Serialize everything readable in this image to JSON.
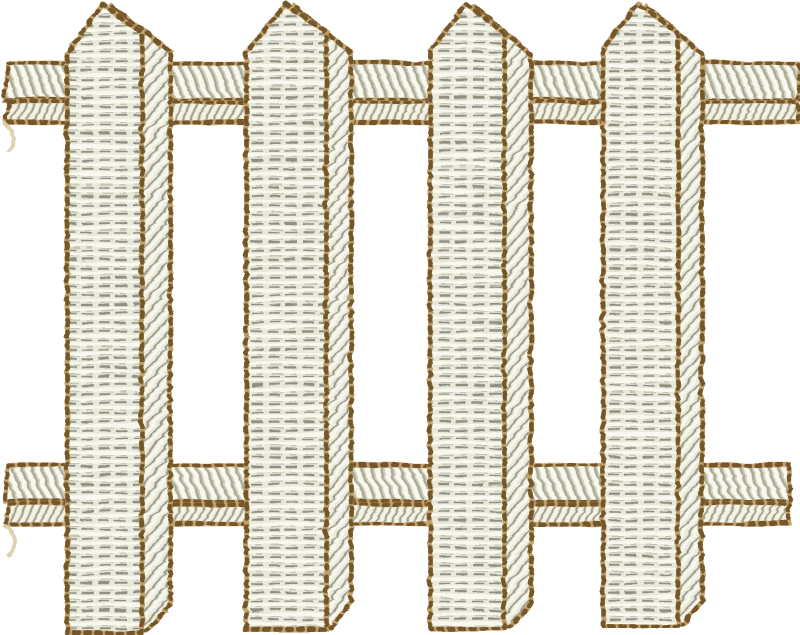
{
  "scene": {
    "description": "embroidery design of a white picket fence, four pointed pickets over two horizontal rails",
    "width": 800,
    "height": 635,
    "background": "#ffffff"
  },
  "palette": {
    "outline_base": "#c2a26c",
    "outline_dark": "#74572c",
    "front_base": "#e8e8db",
    "front_highlight": "#f8f8ef",
    "front_shadow": "#8f9080",
    "front_midtone": "#c6c6b4",
    "side_base": "#eaeadd",
    "side_highlight": "#f7f7ee",
    "side_shadow": "#99998a",
    "rail_upper_base": "#eeeee1",
    "rail_upper_highlight": "#f8f8ef",
    "rail_upper_shadow": "#a9a996",
    "rail_upper_midtone": "#cfcfbc",
    "rail_lower_base": "#e6e6d6",
    "rail_lower_highlight": "#f4f4e6",
    "rail_lower_shadow": "#a39b85",
    "travel_stitch": "#d9cda9"
  },
  "rails": [
    {
      "name": "top-rail",
      "strips": [
        {
          "kind": "upper",
          "x1": 3,
          "x2": 798,
          "y1": 62,
          "y2": 99
        },
        {
          "kind": "lower",
          "x1": 4,
          "x2": 797,
          "y1": 101,
          "y2": 121
        }
      ]
    },
    {
      "name": "bottom-rail",
      "strips": [
        {
          "kind": "upper",
          "x1": 3,
          "x2": 789,
          "y1": 464,
          "y2": 500
        },
        {
          "kind": "lower",
          "x1": 4,
          "x2": 788,
          "y1": 503,
          "y2": 523
        }
      ]
    }
  ],
  "pickets": [
    {
      "fl": 66,
      "fr": 141,
      "sr": 169,
      "px": 101,
      "py": 3,
      "lsh": 53,
      "rc": 33,
      "ssh": 50,
      "b": 632,
      "sb": 602
    },
    {
      "fl": 245,
      "fr": 325,
      "sr": 350,
      "px": 285,
      "py": 3,
      "lsh": 50,
      "rc": 32,
      "ssh": 52,
      "b": 628,
      "sb": 600
    },
    {
      "fl": 429,
      "fr": 503,
      "sr": 530,
      "px": 466,
      "py": 3,
      "lsh": 50,
      "rc": 32,
      "ssh": 54,
      "b": 628,
      "sb": 603
    },
    {
      "fl": 602,
      "fr": 677,
      "sr": 701,
      "px": 637,
      "py": 3,
      "lsh": 48,
      "rc": 31,
      "ssh": 52,
      "b": 625,
      "sb": 600
    }
  ],
  "travel_stitches": [
    {
      "d": "M3,122 C 11,128 16,138 8,150"
    },
    {
      "d": "M3,524 C 13,530 18,542 8,554"
    }
  ],
  "stroke": {
    "picket_width": 5,
    "rail_width": 4.5,
    "dash": "4.5 6.5"
  }
}
